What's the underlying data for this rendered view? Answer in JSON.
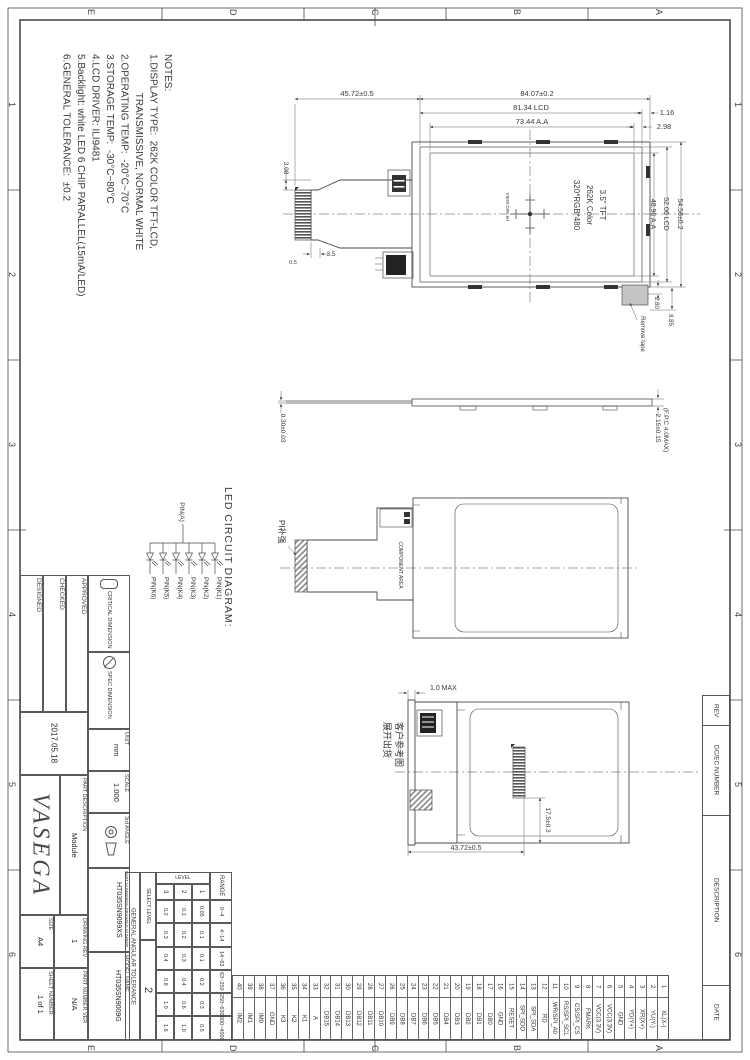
{
  "zones": {
    "letters": [
      "E",
      "D",
      "C",
      "B",
      "A"
    ],
    "numbers": [
      "1",
      "2",
      "3",
      "4",
      "5",
      "6"
    ]
  },
  "notes": {
    "title": "NOTES:",
    "lines": [
      "1.DISPLAY TYPE:  262K COLOR TFT-LCD,",
      "              TRANSMISSIVE, NORMAL WHITE",
      "2.OPERATING TEMP:  -20°C~70°C",
      "3.STORAGE TEMP:  -30°C~80°C",
      "4.LCD DRIVER: ILI9481",
      "5.Backlight: white LED 6 CHIP PARALLEL(15mA/LED)",
      "6.GENERAL TOLERANCE:  ±0.2"
    ]
  },
  "front_view": {
    "dim_fpc_width": "45.72±0.5",
    "dim_module_width": "84.07±0.2",
    "dim_lcd_width": "81.34 LCD",
    "dim_aa_width": "73.44 A.A",
    "dim_right_gap1": "1.16",
    "dim_right_gap2": "2.98",
    "dim_module_height": "54.56±0.2",
    "dim_lcd_height": "52.06 LCD",
    "dim_aa_height": "48.96 A.A",
    "dim_bottom_gap1": "2.80",
    "dim_bottom_gap2": "8.85",
    "dim_fpc_1": "3.08",
    "dim_fpc_2": "3.5",
    "dim_fpc_3": "0.5",
    "panel_text": [
      "3.5\" TFT",
      "262K Color",
      "320*RGB*480"
    ],
    "view_dir": "VIEW DIR. 6H",
    "remove_tape": "Remove tape"
  },
  "side_view": {
    "dim_fpc_thickness": "0.30±0.03",
    "dim_total_thickness": "2.15±0.15",
    "dim_total_note": "(F.P.C 4.0MAX)"
  },
  "led_diagram": {
    "title": "LED CIRCUIT DIAGRAM:",
    "anode": "PIN(A)",
    "cathodes": [
      "PIN(K6)",
      "PIN(K5)",
      "PIN(K4)",
      "PIN(K3)",
      "PIN(K2)",
      "PIN(K1)"
    ]
  },
  "back_view": {
    "pi_label": "PI补强",
    "component_area": "COMPONENT AREA"
  },
  "unfold_view": {
    "dim_fpc_end": "1.0 MAX",
    "dim_unfold_length": "43.72±0.5",
    "dim_connector": "17.5±0.3",
    "customer_note": [
      "客户参考图",
      "展开出货"
    ]
  },
  "title_block": {
    "designed_label": "DESIGNED",
    "checked_label": "CHECKED",
    "approved_label": "APPROVED",
    "date": "2017.05.18",
    "company": "VASEGA",
    "part_description_label": "PART DESCRIPTION",
    "part_description": "Module",
    "size_label": "SIZE",
    "size": "A4",
    "drawing_rev_label": "DRAWING REV",
    "drawing_rev": "1",
    "sheet_number_label": "SHEET NUMBER",
    "sheet_number": "1 of 1",
    "part_number_ver_label": "PART NUMBER VER",
    "part_number_ver": "N/A",
    "critical_dimension_label": "CRITICAL DIMENSION",
    "spec_dimension_label": "SPEC DIMENSION",
    "unit_label": "UNIT",
    "unit": "mm",
    "scale_label": "SCALE",
    "scale": "1.000",
    "angle_label": "3rd ANGLE",
    "part_number_label": "PART NUMBER/IN-DRAWING NUMBER",
    "part_number": "HT035SN9099XS",
    "model_name_label": "MODEL NAME",
    "model_name": "HT035SN9009G"
  },
  "tolerance_table": {
    "title": "GENERAL ANGULAR TOLERANCE",
    "range_header": "RANGE",
    "level_header": "LEVEL",
    "level_cols": [
      "1",
      "2",
      "3"
    ],
    "rows": [
      {
        "range": "0~4",
        "l1": "0.05",
        "l2": "0.1",
        "l3": "0.2"
      },
      {
        "range": "4~14",
        "l1": "0.1",
        "l2": "0.2",
        "l3": "0.3"
      },
      {
        "range": "14~63",
        "l1": "0.1",
        "l2": "0.3",
        "l3": "0.4"
      },
      {
        "range": "63~250",
        "l1": "0.2",
        "l2": "0.4",
        "l3": "0.8"
      },
      {
        "range": "250~630",
        "l1": "0.3",
        "l2": "0.6",
        "l3": "1.0"
      },
      {
        "range": "600~4000",
        "l1": "0.5",
        "l2": "1.0",
        "l3": "1.6"
      }
    ],
    "select_label": "SELECT LEVEL",
    "select_value": "2"
  },
  "pin_table": {
    "pins": [
      {
        "no": "1",
        "name": "XL(X-)"
      },
      {
        "no": "2",
        "name": "YU(Y-)"
      },
      {
        "no": "3",
        "name": "XR(X+)"
      },
      {
        "no": "4",
        "name": "YD(Y+)"
      },
      {
        "no": "5",
        "name": "GND"
      },
      {
        "no": "6",
        "name": "VCC(3.3V)"
      },
      {
        "no": "7",
        "name": "VCC(3.3V)"
      },
      {
        "no": "8",
        "name": "FMARK"
      },
      {
        "no": "9",
        "name": "CS/SPI_CS"
      },
      {
        "no": "10",
        "name": "RS/SPI_SCL"
      },
      {
        "no": "11",
        "name": "WR/SPI_A0"
      },
      {
        "no": "12",
        "name": "RD"
      },
      {
        "no": "13",
        "name": "SPI_SDA"
      },
      {
        "no": "14",
        "name": "SPI_SDO"
      },
      {
        "no": "15",
        "name": "RESET"
      },
      {
        "no": "16",
        "name": "GND"
      },
      {
        "no": "17",
        "name": "DB0"
      },
      {
        "no": "18",
        "name": "DB1"
      },
      {
        "no": "19",
        "name": "DB2"
      },
      {
        "no": "20",
        "name": "DB3"
      },
      {
        "no": "21",
        "name": "DB4"
      },
      {
        "no": "22",
        "name": "DB5"
      },
      {
        "no": "23",
        "name": "DB6"
      },
      {
        "no": "24",
        "name": "DB7"
      },
      {
        "no": "25",
        "name": "DB8"
      },
      {
        "no": "26",
        "name": "DB9"
      },
      {
        "no": "27",
        "name": "DB10"
      },
      {
        "no": "28",
        "name": "DB11"
      },
      {
        "no": "29",
        "name": "DB12"
      },
      {
        "no": "30",
        "name": "DB13"
      },
      {
        "no": "31",
        "name": "DB14"
      },
      {
        "no": "32",
        "name": "DB15"
      },
      {
        "no": "33",
        "name": "A"
      },
      {
        "no": "34",
        "name": "K1"
      },
      {
        "no": "35",
        "name": "K2"
      },
      {
        "no": "36",
        "name": "K3"
      },
      {
        "no": "37",
        "name": "GND"
      },
      {
        "no": "38",
        "name": "IM0"
      },
      {
        "no": "39",
        "name": "IM1"
      },
      {
        "no": "40",
        "name": "IM2"
      }
    ]
  },
  "revision": {
    "headers": [
      "REV",
      "DC/EC NUMBER",
      "DESCRIPTION",
      "DATE"
    ]
  }
}
